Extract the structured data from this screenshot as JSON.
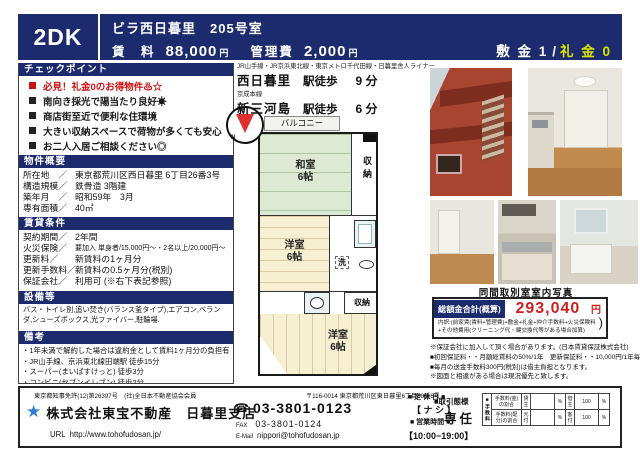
{
  "colors": {
    "accent_navy": "#1c2a6e",
    "key_money_yellow": "#dce600",
    "price_red": "#cc2020",
    "checkpoint_red": "#cc1111",
    "star_blue": "#2f7fd0",
    "compass_red": "#e03030",
    "tatami_green": "#dcead4",
    "wood_beige": "#f6efd2"
  },
  "header": {
    "layout": "2DK",
    "title": "ビラ西日暮里　205号室",
    "rent_label": "賃　料",
    "rent_value": "88,000",
    "rent_unit": "円",
    "mgmt_label": "管理費",
    "mgmt_value": "2,000",
    "mgmt_unit": "円",
    "deposit": "敷 金 1",
    "slash": "/",
    "key_money": "礼 金 0"
  },
  "checkpoints": {
    "title": "チェックポイント",
    "items": [
      "必見！礼金0のお得物件♨☆",
      "南向き採光で陽当たり良好☀",
      "商店街至近で便利な住環境",
      "大きい収納スペースで荷物が多くても安心",
      "お二人入居ご相談ください◎"
    ]
  },
  "overview": {
    "title": "物件概要",
    "rows": [
      {
        "label": "所在地　／",
        "value": "東京都荒川区西日暮里 6丁目26番3号"
      },
      {
        "label": "構造規模／",
        "value": "鉄骨造 3階建"
      },
      {
        "label": "築年月　／",
        "value": "昭和59年　3月"
      },
      {
        "label": "専有面積／",
        "value": "40㎡"
      }
    ]
  },
  "lease": {
    "title": "賃貸条件",
    "rows": [
      {
        "label": "契約期間／",
        "value": "2年間"
      },
      {
        "label": "火災保険／",
        "value": "要加入 単身者/15,000円〜・2名以上/20,000円〜"
      },
      {
        "label": "更新料／",
        "value": "新賃料の1ヶ月分"
      },
      {
        "label": "更新手数料／",
        "value": "新賃料の0.5ヶ月分(税別)"
      },
      {
        "label": "保証会社／",
        "value": "利用可 (※右下表記参照)"
      }
    ]
  },
  "equipment": {
    "title": "設備等",
    "text": "バス・トイレ別,追い焚き(バランス釜タイプ),エアコン,ベランダ,シューズボックス,光ファイバー,駐輪場."
  },
  "remarks": {
    "title": "備考",
    "items": [
      "・1年未満で解約した場合は違約金として賃料1ヶ月分の負担有",
      "・JR山手線、京浜東北線田端駅 徒歩15分",
      "・スーパー(まいばすけっと) 徒歩3分",
      "・コンビニ(セブンイレブン) 徒歩2分"
    ]
  },
  "access": {
    "lines1": "JR山手線・JR京浜東北線・東京メトロ千代田線・日暮里舎人ライナー",
    "station1": "西日暮里",
    "walk1": "駅徒歩",
    "min1": "9 分",
    "lines2": "京成本線",
    "station2": "新三河島",
    "walk2": "駅徒歩",
    "min2": "6 分"
  },
  "floorplan": {
    "balcony": "バルコニー",
    "room1_name": "和室",
    "room1_size": "6帖",
    "closet1": "収納",
    "room2_name": "洋室",
    "room2_size": "6帖",
    "laundry": "洗",
    "closet2": "収納",
    "room3_name": "洋室",
    "room3_size": "6帖",
    "compass_n": "N"
  },
  "photos": {
    "caption": "同間取別室室内写真"
  },
  "total": {
    "label": "総額金合計(概算)",
    "value": "293,040",
    "unit": "円",
    "breakdown1": "内訳:(前家賃(賃料+管理費)+敷金+礼金+仲介手数料+火災保険料",
    "breakdown2": "+その他費用(クリーニング代・鍵交換代等がある場合加算)",
    "paren": ")"
  },
  "guarantee": {
    "lines": [
      "※保証会社に加入して頂く場合があります。(日本賃貸保証株式会社)",
      "■初回保証料・・月額総賃料の50%/1年　更新保証料・・10,000円/1年毎",
      "■毎月の送金手数料300円(税別)は借主負担となります。",
      "※図面と相違がある場合は現況優先と致します。"
    ]
  },
  "footer": {
    "license": "東京都知事免許(12)第26397号　(社)全日本不動産協会会員",
    "star_icon": "★",
    "company": "株式会社東宝不動産　日暮里支店",
    "url_label": "URL",
    "url": "http://www.tohofudosan.jp/",
    "postal": "〒116-0014 東京都荒川区東日暮里6丁目58番6号",
    "tel_icon": "☎",
    "tel": "03-3801-0123",
    "fax_label": "FAX",
    "fax": "03-3801-0124",
    "email_label": "E-Mail",
    "email": "nippori@tohofudosan.jp",
    "closed_label": "■ 定 休 日 ■",
    "closed": "【 ナ シ 】",
    "hours_label": "■ 営業時間 ■",
    "hours": "【10:00−19:00】",
    "dealtype_label": "■取引態様",
    "dealtype": "専任",
    "fee_table": {
      "head": "■手数料",
      "rows": [
        {
          "name": "手数料(金)の割合",
          "p1": "貸主",
          "v1": "",
          "u1": "%",
          "p2": "借主",
          "v2": "100",
          "u2": "%"
        },
        {
          "name": "手数料(配分)の割合",
          "p1": "元付",
          "v1": "",
          "u1": "%",
          "p2": "客付",
          "v2": "100",
          "u2": "%"
        }
      ]
    }
  }
}
